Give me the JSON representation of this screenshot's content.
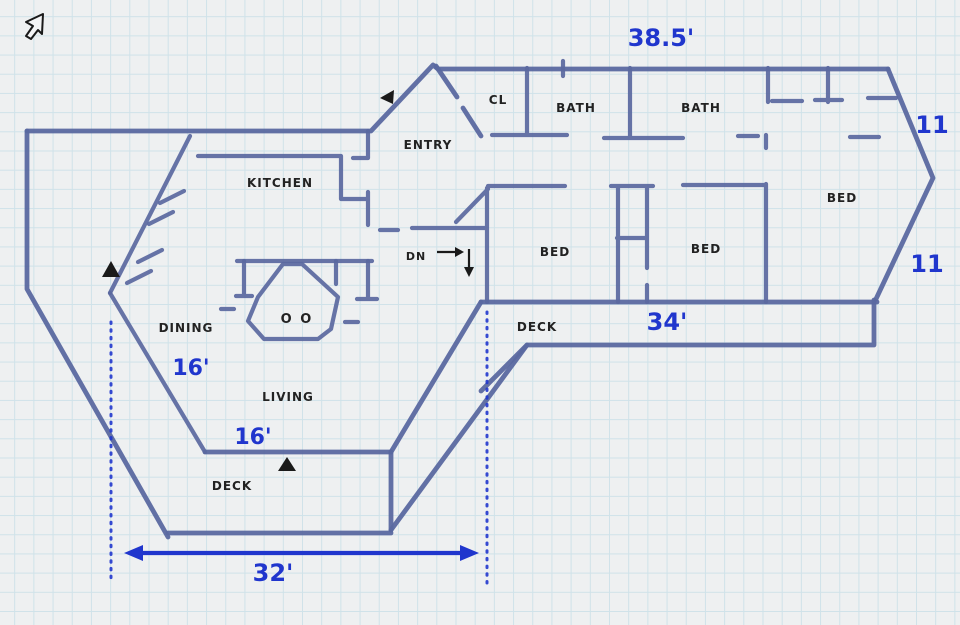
{
  "colors": {
    "background": "#eef0f1",
    "grid": "#cfe2e9",
    "wall": "#5a68a0",
    "dimension": "#2036cd",
    "label": "#222222",
    "marker": "#1a1a1a"
  },
  "icons": {
    "cursor_pointer": "arrow-pointer"
  },
  "rooms": {
    "kitchen": "KITCHEN",
    "entry": "ENTRY",
    "closet": "CL",
    "bath_left": "BATH",
    "bath_right": "BATH",
    "bed_left": "BED",
    "bed_middle": "BED",
    "bed_right": "BED",
    "dining": "DINING",
    "living": "LIVING",
    "deck_upper": "DECK",
    "deck_lower": "DECK"
  },
  "annotations": {
    "stairs_label": "DN",
    "fireplace_label": "O O"
  },
  "dimensions": {
    "top_width": "38.5'",
    "side_upper": "11",
    "side_lower": "11",
    "wing_width": "34'",
    "dining_wall": "16'",
    "living_wall": "16'",
    "deck_width": "32'"
  }
}
